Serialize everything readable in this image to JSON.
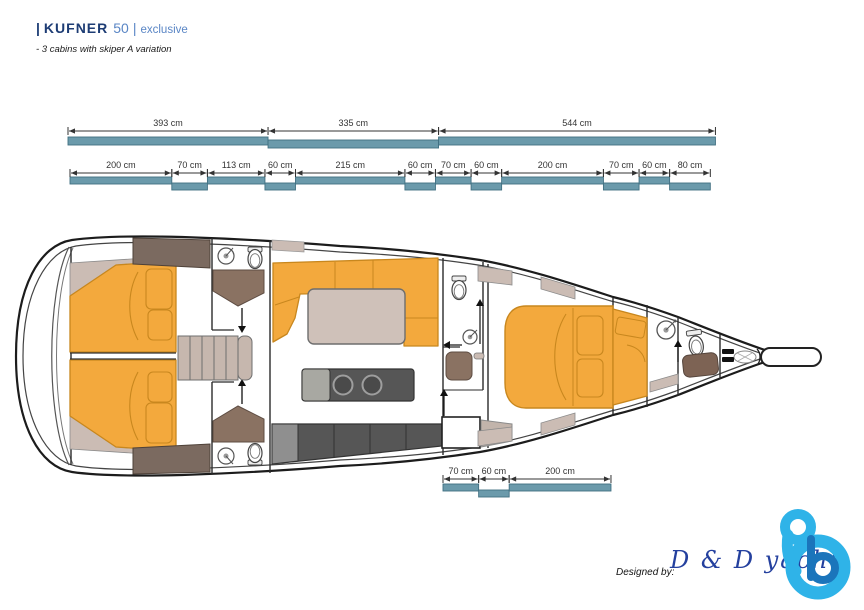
{
  "header": {
    "title_prefix": "|",
    "brand": "KUFNER",
    "model": "50",
    "title_separator": "|",
    "edition": "exclusive",
    "subtitle": "- 3 cabins with skiper A variation"
  },
  "dimensions": {
    "unit": "cm",
    "rows": [
      {
        "id": "upper-overall",
        "segments": [
          {
            "label": "393 cm",
            "cm": 393
          },
          {
            "label": "335 cm",
            "cm": 335
          },
          {
            "label": "544 cm",
            "cm": 544
          }
        ]
      },
      {
        "id": "upper-detail",
        "segments": [
          {
            "label": "200 cm",
            "cm": 200
          },
          {
            "label": "70 cm",
            "cm": 70
          },
          {
            "label": "113 cm",
            "cm": 113
          },
          {
            "label": "60 cm",
            "cm": 60
          },
          {
            "label": "215 cm",
            "cm": 215
          },
          {
            "label": "60 cm",
            "cm": 60
          },
          {
            "label": "70 cm",
            "cm": 70
          },
          {
            "label": "60 cm",
            "cm": 60
          },
          {
            "label": "200 cm",
            "cm": 200
          },
          {
            "label": "70 cm",
            "cm": 70
          },
          {
            "label": "60 cm",
            "cm": 60
          },
          {
            "label": "80 cm",
            "cm": 80
          }
        ]
      },
      {
        "id": "cockpit",
        "segments": [
          {
            "label": "70 cm",
            "cm": 70
          },
          {
            "label": "60 cm",
            "cm": 60
          },
          {
            "label": "200 cm",
            "cm": 200
          }
        ]
      }
    ]
  },
  "footer": {
    "designed_by": "Designed by:",
    "studio": "D & D yacht"
  },
  "colors": {
    "dimension_bar": "#6b9aab",
    "dimension_bar_border": "#417082",
    "plan_orange": "#f3a93d",
    "plan_orange_border": "#c8871e",
    "plan_brown": "#8a7262",
    "plan_dark_brown": "#7b6a60",
    "plan_tan": "#cbbcb4",
    "counter_gray": "#565656",
    "logo_light_blue": "#2fb3e8",
    "logo_dark_blue": "#1b75bb",
    "brand_navy": "#1d3c74",
    "brand_blue": "#5a86c5",
    "script_blue": "#24409e"
  }
}
